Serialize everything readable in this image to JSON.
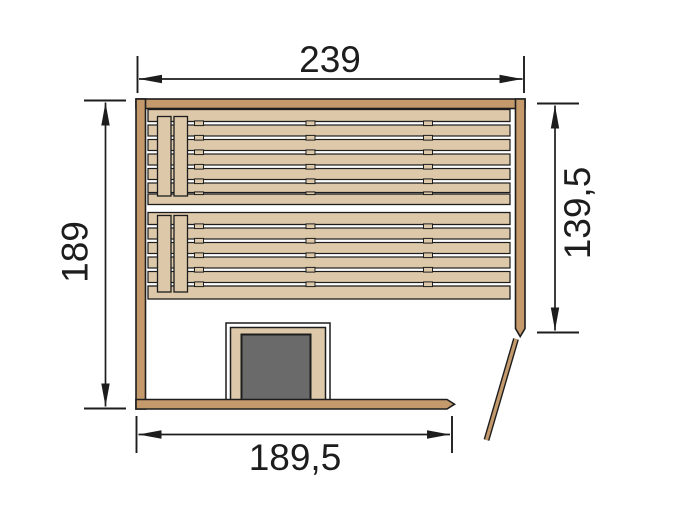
{
  "diagram": {
    "dimension_labels": {
      "top_width": "239",
      "left_height": "189",
      "right_height": "139,5",
      "bottom_width": "189,5"
    },
    "colors": {
      "wall": "#c49a6c",
      "bench": "#ddc9a9",
      "heater": "#6a6a6a",
      "line": "#1d1d1d",
      "background": "#ffffff"
    }
  }
}
